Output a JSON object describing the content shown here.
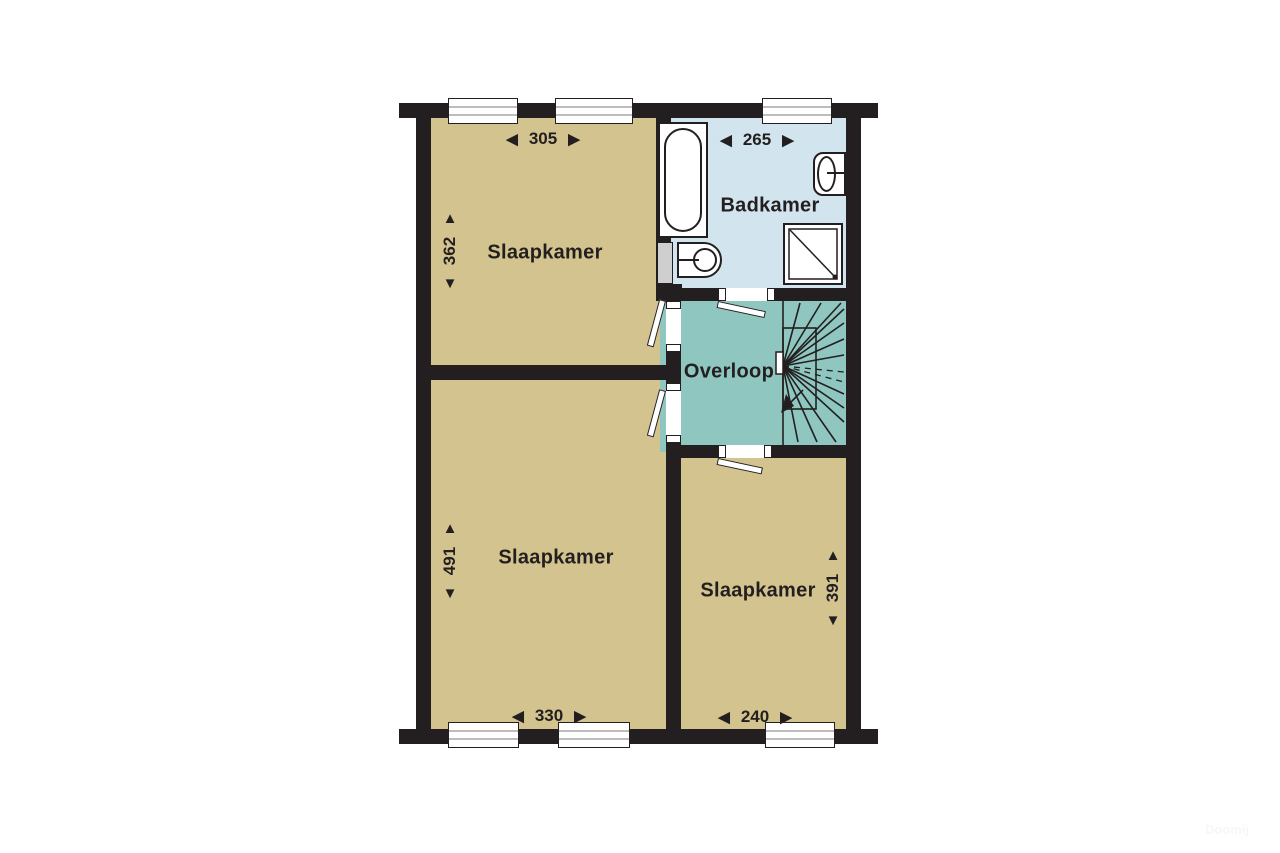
{
  "rooms": {
    "bedroom_top_left": {
      "label": "Slaapkamer",
      "width_cm": "305",
      "depth_cm": "362"
    },
    "bathroom": {
      "label": "Badkamer",
      "width_cm": "265"
    },
    "landing": {
      "label": "Overloop"
    },
    "bedroom_bottom_left": {
      "label": "Slaapkamer",
      "width_cm": "330",
      "depth_cm": "491"
    },
    "bedroom_bottom_right": {
      "label": "Slaapkamer",
      "width_cm": "240",
      "depth_cm": "391"
    }
  },
  "dim_arrows": {
    "left": "◀",
    "right": "▶",
    "up": "▲",
    "down": "▼"
  },
  "icons": [
    "bathtub-icon",
    "pedestal-sink-icon",
    "wall-basin-icon",
    "shower-icon",
    "stairs-icon",
    "window-icon",
    "door-leaf"
  ],
  "colors": {
    "wall": "#231f20",
    "bedroom_floor": "#d3c38e",
    "bathroom_floor": "#d2e4ee",
    "landing_floor": "#8fc7c0",
    "window_stripe": "#bdbdbd",
    "shaft_fill": "#cfcfcf"
  },
  "watermark": {
    "text": "Doomij"
  }
}
